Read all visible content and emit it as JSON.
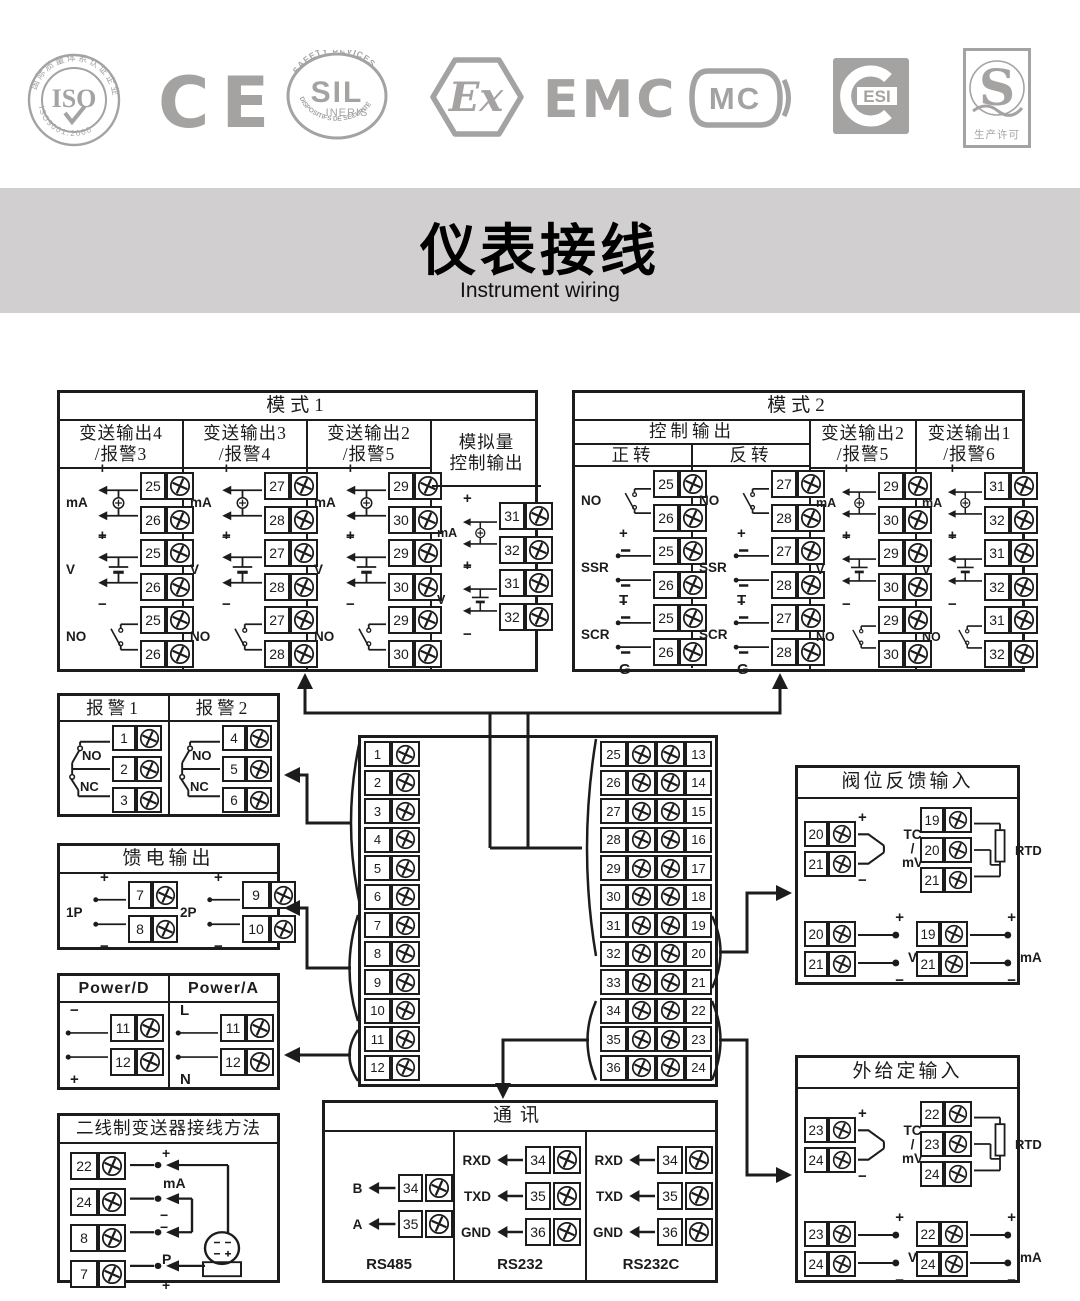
{
  "sym": {
    "plus": "+",
    "minus": "−",
    "mA": "mA",
    "V": "V",
    "NO": "NO",
    "NC": "NC",
    "SSR": "SSR",
    "SCR": "SCR",
    "T": "T",
    "G": "G",
    "TC": "TC",
    "slash": "/",
    "mV": "mV",
    "RTD": "RTD",
    "P": "P",
    "B": "B",
    "A": "A",
    "L": "L",
    "N": "N",
    "RXD": "RXD",
    "TXD": "TXD",
    "GND": "GND"
  },
  "logos": {
    "iso": {
      "center": "ISO",
      "ring_top": "国际质量体系认证企业",
      "ring_bottom": "ISO9001:2000"
    },
    "ce": {
      "text": "CE"
    },
    "sil": {
      "center": "SIL",
      "sub": "INERIS",
      "arc_top": "SAFETY DEVICES",
      "arc_bottom": "DISPOSITIFS DE SÉCURITÉ"
    },
    "ex": {
      "text": "Ex"
    },
    "emc": {
      "text": "EMC"
    },
    "mc": {
      "text": "MC"
    },
    "cesi": {
      "text": "ESI"
    },
    "s": {
      "text": "S",
      "sub": "生产许可"
    }
  },
  "title": {
    "zh": "仪表接线",
    "en": "Instrument wiring"
  },
  "mode1": {
    "title": "模式1",
    "row_labels": [
      "mA",
      "V",
      "NO"
    ],
    "columns": [
      {
        "h1": "变送输出4",
        "h2": "/报警3",
        "pairs": [
          [
            "25",
            "26"
          ],
          [
            "25",
            "26"
          ],
          [
            "25",
            "26"
          ]
        ]
      },
      {
        "h1": "变送输出3",
        "h2": "/报警4",
        "pairs": [
          [
            "27",
            "28"
          ],
          [
            "27",
            "28"
          ],
          [
            "27",
            "28"
          ]
        ]
      },
      {
        "h1": "变送输出2",
        "h2": "/报警5",
        "pairs": [
          [
            "29",
            "30"
          ],
          [
            "29",
            "30"
          ],
          [
            "29",
            "30"
          ]
        ]
      },
      {
        "h1": "模拟量",
        "h2": "控制输出",
        "row_labels": [
          "mA",
          "V"
        ],
        "pairs": [
          [
            "31",
            "32"
          ],
          [
            "31",
            "32"
          ]
        ]
      }
    ]
  },
  "mode2": {
    "title": "模式2",
    "group_header": "控制输出",
    "columns": [
      {
        "h1": "正转",
        "labels": [
          "NO",
          "SSR",
          "SCR"
        ],
        "pairs": [
          [
            "25",
            "26"
          ],
          [
            "25",
            "26"
          ],
          [
            "25",
            "26"
          ]
        ]
      },
      {
        "h1": "反转",
        "labels": [
          "NO",
          "SSR",
          "SCR"
        ],
        "pairs": [
          [
            "27",
            "28"
          ],
          [
            "27",
            "28"
          ],
          [
            "27",
            "28"
          ]
        ]
      },
      {
        "h1": "变送输出2",
        "h2": "/报警5",
        "labels": [
          "mA",
          "V",
          "NO"
        ],
        "pairs": [
          [
            "29",
            "30"
          ],
          [
            "29",
            "30"
          ],
          [
            "29",
            "30"
          ]
        ]
      },
      {
        "h1": "变送输出1",
        "h2": "/报警6",
        "labels": [
          "mA",
          "V",
          "NO"
        ],
        "pairs": [
          [
            "31",
            "32"
          ],
          [
            "31",
            "32"
          ],
          [
            "31",
            "32"
          ]
        ]
      }
    ]
  },
  "alarms": {
    "columns": [
      {
        "header": "报警1",
        "t": [
          "1",
          "2",
          "3"
        ]
      },
      {
        "header": "报警2",
        "t": [
          "4",
          "5",
          "6"
        ]
      }
    ]
  },
  "feed": {
    "title": "馈电输出",
    "groups": [
      {
        "label": "1P",
        "t": [
          "7",
          "8"
        ]
      },
      {
        "label": "2P",
        "t": [
          "9",
          "10"
        ]
      }
    ]
  },
  "power": {
    "columns": [
      {
        "header": "Power/D",
        "top": "−",
        "bottom": "+",
        "t": [
          "11",
          "12"
        ]
      },
      {
        "header": "Power/A",
        "top": "L",
        "bottom": "N",
        "t": [
          "11",
          "12"
        ]
      }
    ]
  },
  "twowire": {
    "title": "二线制变送器接线方法",
    "t": [
      "22",
      "24",
      "8",
      "7"
    ],
    "labels": {
      "r1_top": "+",
      "r1_bottom": "mA",
      "r2": "−",
      "r3": "−",
      "r4_top": "P",
      "r4_bottom": "+"
    },
    "transmitter_marks": "−− / −+"
  },
  "center": {
    "left": [
      "1",
      "2",
      "3",
      "4",
      "5",
      "6",
      "7",
      "8",
      "9",
      "10",
      "11",
      "12"
    ],
    "mid": [
      "25",
      "26",
      "27",
      "28",
      "29",
      "30",
      "31",
      "32",
      "33",
      "34",
      "35",
      "36"
    ],
    "right": [
      "13",
      "14",
      "15",
      "16",
      "17",
      "18",
      "19",
      "20",
      "21",
      "22",
      "23",
      "24"
    ]
  },
  "valve": {
    "title": "阀位反馈输入",
    "tc_t": [
      "20",
      "21"
    ],
    "rtd_t": [
      "19",
      "20",
      "21"
    ],
    "v_t": [
      "20",
      "21"
    ],
    "ma_t": [
      "19",
      "21"
    ]
  },
  "ext": {
    "title": "外给定输入",
    "tc_t": [
      "23",
      "24"
    ],
    "rtd_t": [
      "22",
      "23",
      "24"
    ],
    "v_t": [
      "23",
      "24"
    ],
    "ma_t": [
      "22",
      "24"
    ]
  },
  "comm": {
    "title": "通讯",
    "sections": [
      {
        "name": "RS485",
        "rows": [
          {
            "label": "B",
            "t": "34"
          },
          {
            "label": "A",
            "t": "35"
          }
        ]
      },
      {
        "name": "RS232",
        "rows": [
          {
            "label": "RXD",
            "t": "34"
          },
          {
            "label": "TXD",
            "t": "35"
          },
          {
            "label": "GND",
            "t": "36"
          }
        ]
      },
      {
        "name": "RS232C",
        "rows": [
          {
            "label": "RXD",
            "t": "34"
          },
          {
            "label": "TXD",
            "t": "35"
          },
          {
            "label": "GND",
            "t": "36"
          }
        ]
      }
    ]
  }
}
